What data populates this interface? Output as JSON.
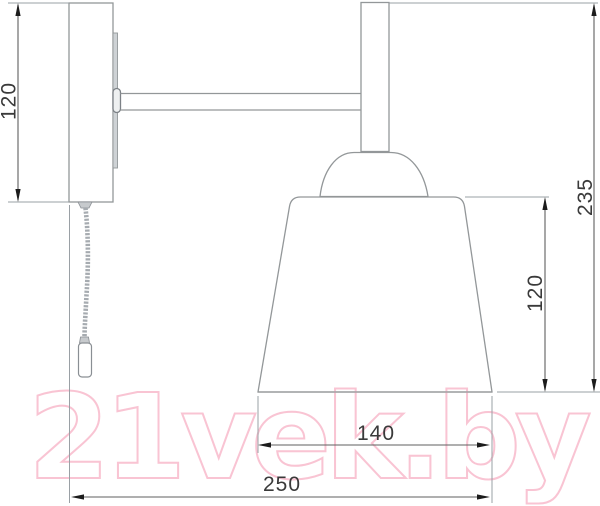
{
  "drawing": {
    "title": "wall-lamp-technical-drawing",
    "dimensions": {
      "bracket_height_mm": "120",
      "overall_height_mm": "235",
      "shade_height_mm": "120",
      "shade_diameter_mm": "140",
      "overall_depth_mm": "250"
    },
    "colors": {
      "structure_outline": "#939799",
      "extension_line": "#9aa0a5",
      "dimension_line": "#5f5f5f",
      "arrow": "#1c1c1c",
      "label": "#3a3a3a"
    }
  },
  "watermark": {
    "text": "21vek.by",
    "color": "#f9c4d3"
  }
}
